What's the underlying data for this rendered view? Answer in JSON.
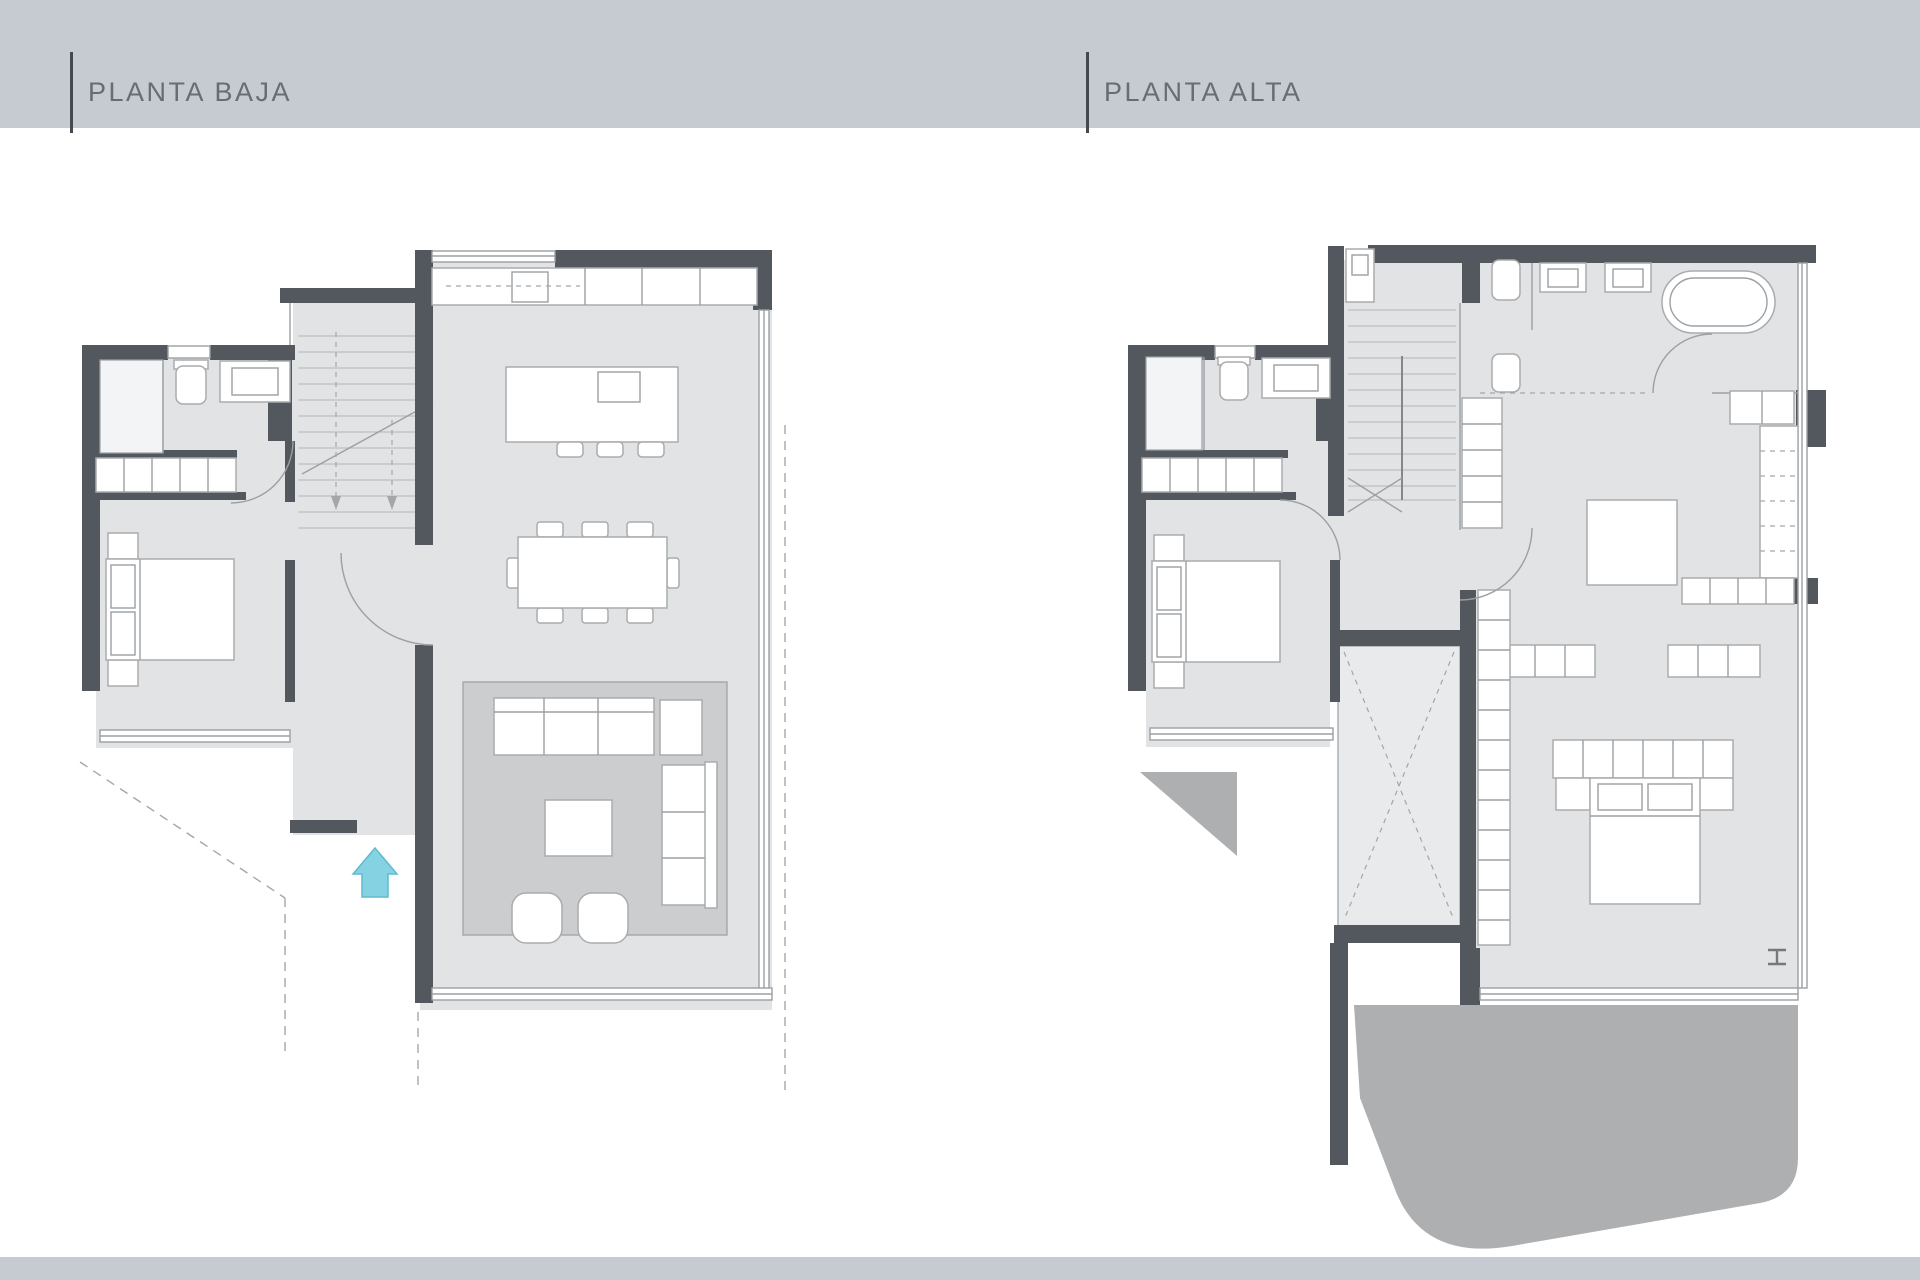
{
  "plans": {
    "planta_baja": {
      "label": "PLANTA BAJA",
      "elements": [
        "bathroom",
        "shower",
        "toilet",
        "sink",
        "wardrobe",
        "bedroom-bed",
        "nightstands",
        "staircase",
        "entrance-arrow",
        "kitchen-counter",
        "cooktop",
        "kitchen-island",
        "island-sink",
        "bar-stools",
        "dining-table",
        "dining-chairs",
        "living-rug",
        "sofa",
        "armchair",
        "chaise-sofa",
        "coffee-table",
        "poufs",
        "windows",
        "porch-dashed-outline"
      ]
    },
    "planta_alta": {
      "label": "PLANTA ALTA",
      "elements": [
        "bathroom",
        "shower",
        "toilet",
        "sink",
        "wardrobe",
        "bedroom-bed",
        "nightstands",
        "staircase",
        "void-over-living",
        "corridor-wardrobe",
        "master-bathroom",
        "double-sink",
        "bathtub",
        "toilet",
        "bidet",
        "dressing-table",
        "closets",
        "walk-in-wardrobe",
        "master-bed",
        "headboard",
        "column-symbol",
        "terrace-triangle",
        "terrace-main",
        "windows"
      ]
    }
  },
  "palette": {
    "band": "#c6cbd1",
    "titleText": "#676d74",
    "titleLine": "#434a52",
    "wall": "#53585e",
    "lines": "#9ba0a4",
    "floor": "#e2e3e4",
    "void": "#e9eaeb",
    "rug": "#cbcdcf",
    "rugStroke": "#a7aaac",
    "terrace": "#adafb1",
    "furn": "#ffffff",
    "furnStroke": "#a9acae",
    "tread": "#bbbec0",
    "dash": "#a3a7aa",
    "arrow": "#85d3e2",
    "arrowStroke": "#5fbacd",
    "shower": "#f3f4f5",
    "column": "#75797d"
  },
  "symbols": {
    "entrance_arrow": "up-arrow",
    "column_symbol": "steel-column-I"
  }
}
